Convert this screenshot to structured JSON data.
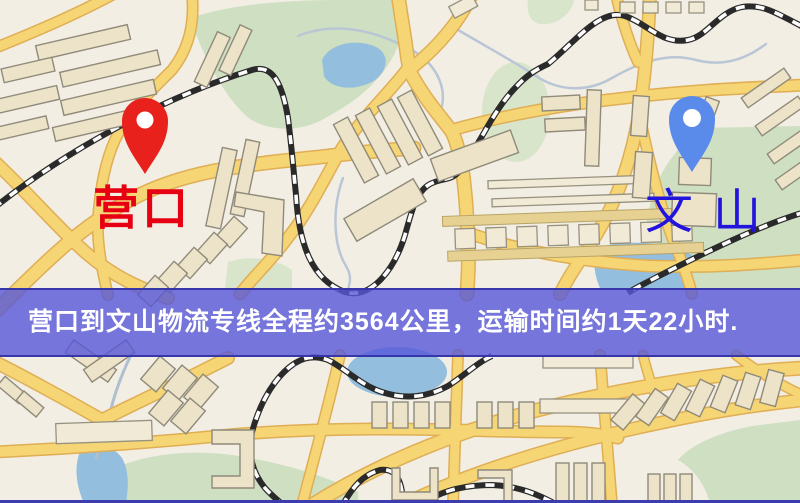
{
  "map": {
    "markers": {
      "origin": {
        "label": "营口",
        "label_color": "#e60012",
        "pin_color": "#e8211c"
      },
      "destination": {
        "label": "文山",
        "label_color": "#2213dd",
        "pin_color": "#5b8bea"
      }
    },
    "colors": {
      "background": "#f2eee3",
      "road": "#f6d574",
      "road_edge": "#dfae55",
      "park": "#cfdfc2",
      "water": "#93bede",
      "building": "#ece3c8",
      "railway": "#2a2a2a"
    }
  },
  "banner": {
    "text": "营口到文山物流专线全程约3564公里，运输时间约1天22小时.",
    "background_color": "#5656d8",
    "text_color": "#ffffff",
    "route": {
      "origin": "营口",
      "destination": "文山",
      "distance_km": "3564",
      "transit_time": "1天22小时"
    }
  }
}
